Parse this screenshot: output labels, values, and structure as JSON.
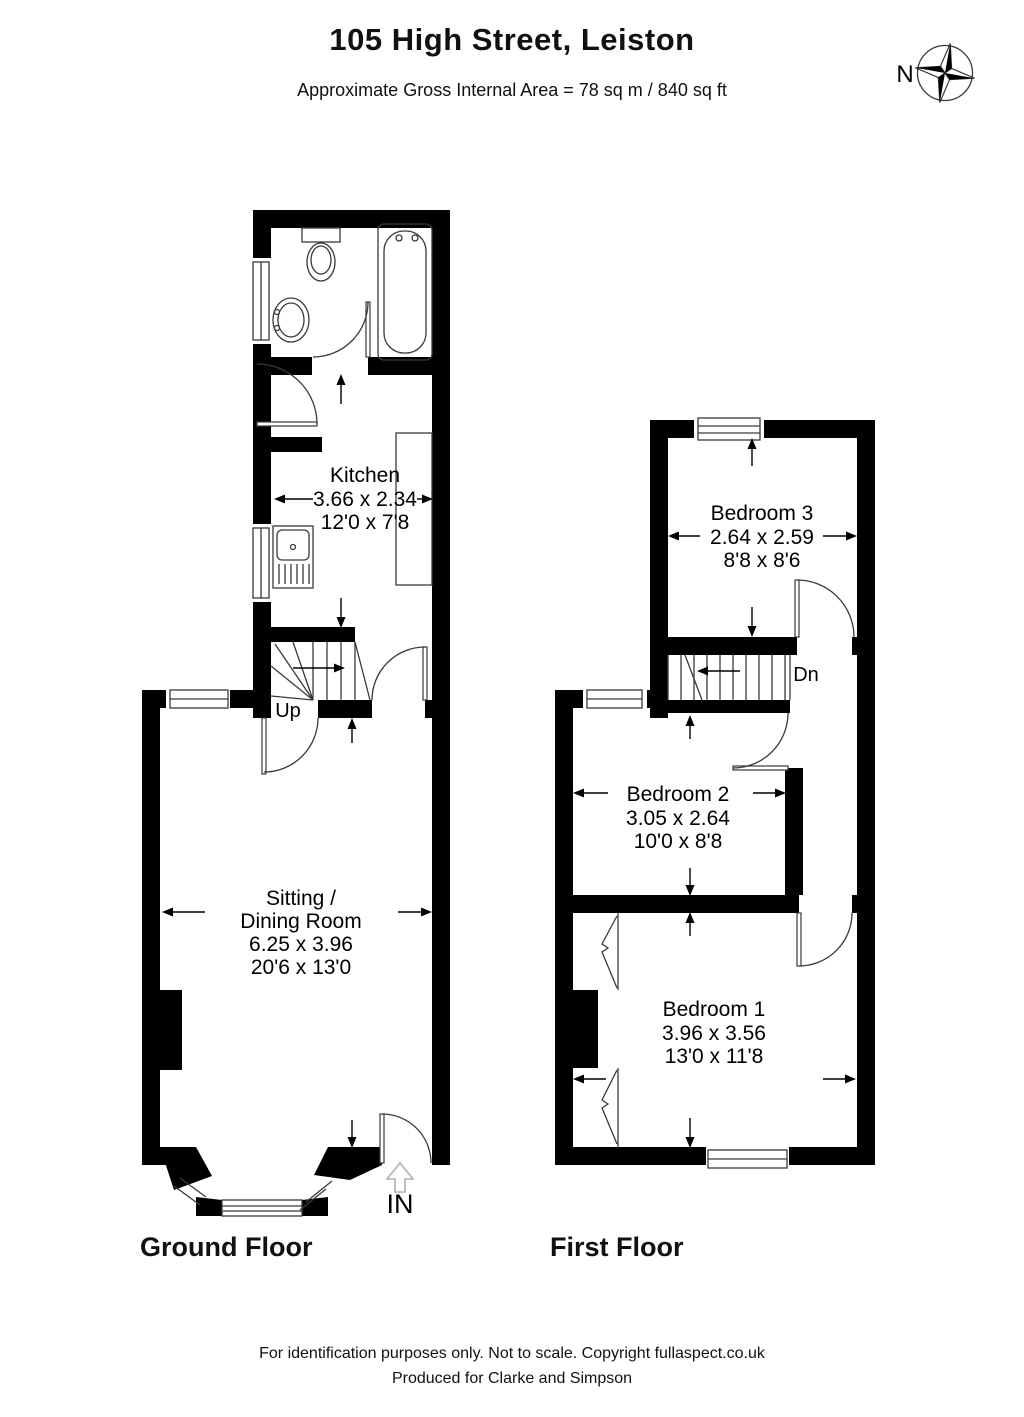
{
  "header": {
    "title": "105 High Street, Leiston",
    "subtitle": "Approximate Gross Internal Area = 78 sq m / 840 sq ft"
  },
  "compass": {
    "north_label": "N"
  },
  "ground_floor": {
    "label": "Ground Floor",
    "stairs_label": "Up",
    "entrance_label": "IN",
    "kitchen": {
      "name": "Kitchen",
      "metric": "3.66 x 2.34",
      "imperial": "12'0 x 7'8"
    },
    "sitting_dining": {
      "name_line1": "Sitting /",
      "name_line2": "Dining Room",
      "metric": "6.25 x 3.96",
      "imperial": "20'6 x 13'0"
    }
  },
  "first_floor": {
    "label": "First Floor",
    "stairs_label": "Dn",
    "bedroom3": {
      "name": "Bedroom 3",
      "metric": "2.64 x 2.59",
      "imperial": "8'8 x 8'6"
    },
    "bedroom2": {
      "name": "Bedroom 2",
      "metric": "3.05 x 2.64",
      "imperial": "10'0 x 8'8"
    },
    "bedroom1": {
      "name": "Bedroom 1",
      "metric": "3.96 x 3.56",
      "imperial": "13'0 x 11'8"
    }
  },
  "footer": {
    "line1": "For identification purposes only. Not to scale. Copyright fullaspect.co.uk",
    "line2": "Produced for Clarke and Simpson"
  },
  "colors": {
    "wall": "#000000",
    "line": "#3a3a3a",
    "background": "#ffffff"
  }
}
